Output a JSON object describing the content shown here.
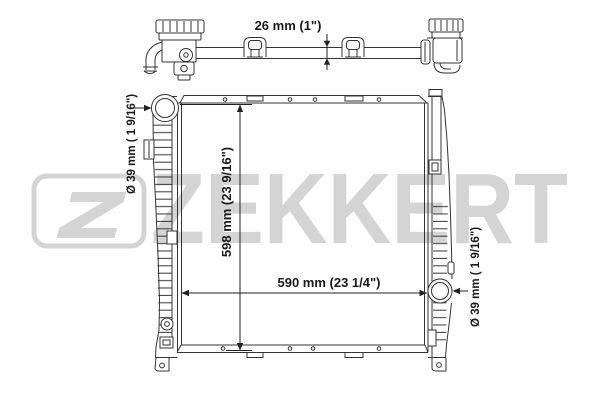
{
  "drawing": {
    "brand_wordmark": "ZEKKERT",
    "top_view": {
      "thickness_label": "26 mm (1\")"
    },
    "front_view": {
      "height_label": "598 mm (23 9/16\")",
      "width_label": "590 mm (23 1/4\")",
      "inlet_diameter_label": "Ø 39 mm ( 1 9/16\")",
      "outlet_diameter_label": "Ø 39 mm ( 1 9/16\")"
    },
    "colors": {
      "line": "#333333",
      "text": "#1a1a1a",
      "watermark": "#d4d4d4",
      "background": "#ffffff"
    }
  }
}
